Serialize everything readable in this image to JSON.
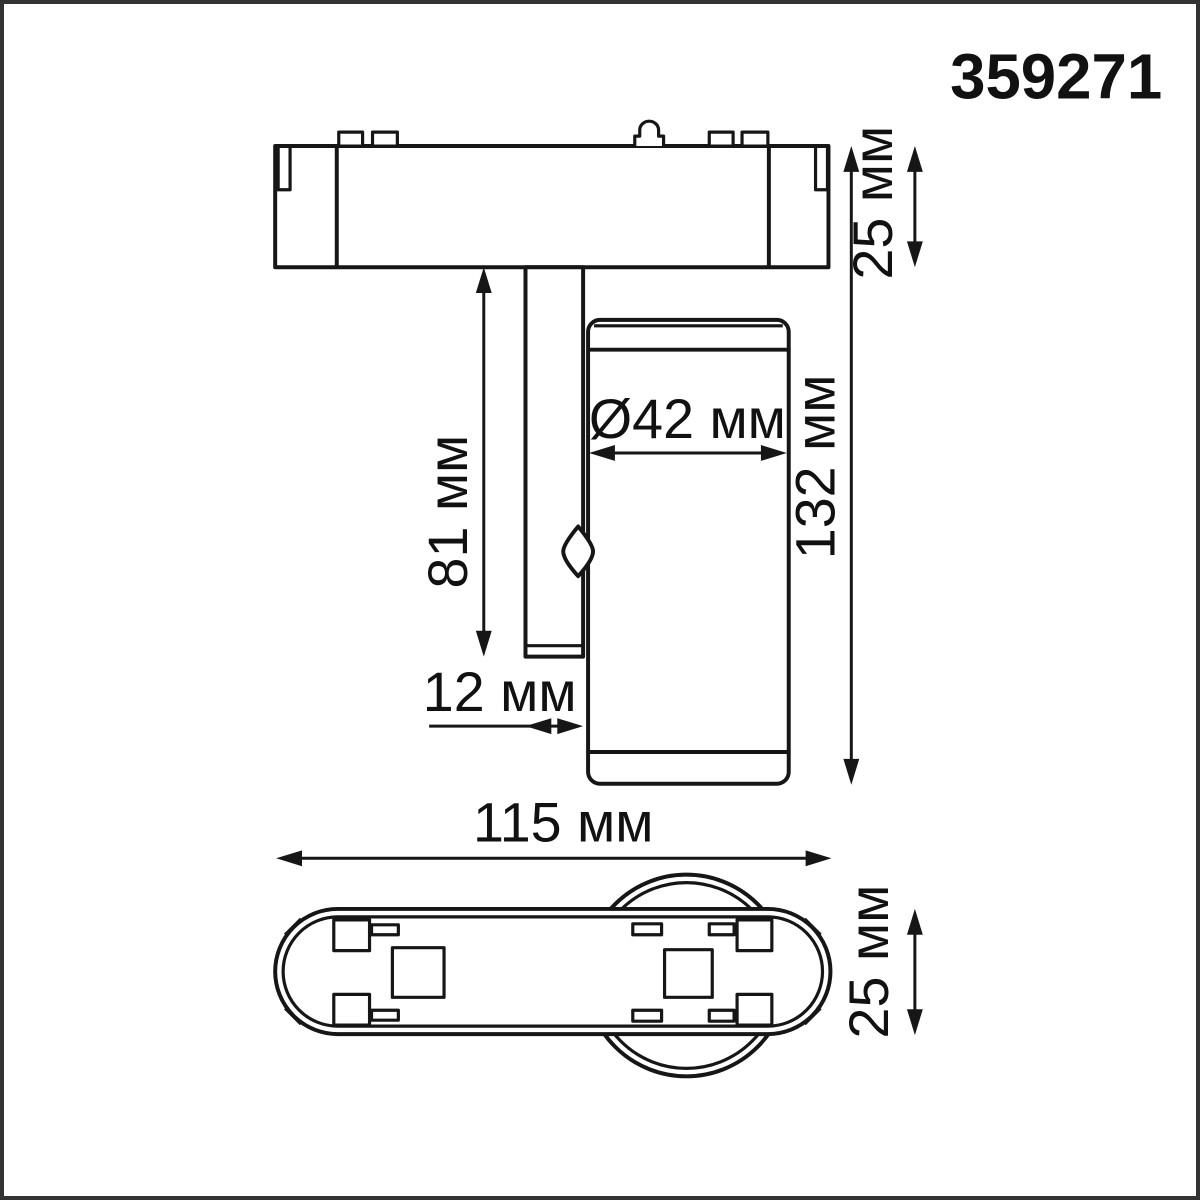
{
  "article": "359271",
  "colors": {
    "line": "#161616",
    "frame": "#333333",
    "background": "#ffffff"
  },
  "side_view": {
    "adapter_height_label": "25 мм",
    "stem_length_label": "81 мм",
    "head_diameter_label": "Ø42 мм",
    "total_height_label": "132 мм",
    "stem_width_label": "12 мм"
  },
  "bottom_view": {
    "length_label": "115 мм",
    "width_label": "25 мм"
  }
}
